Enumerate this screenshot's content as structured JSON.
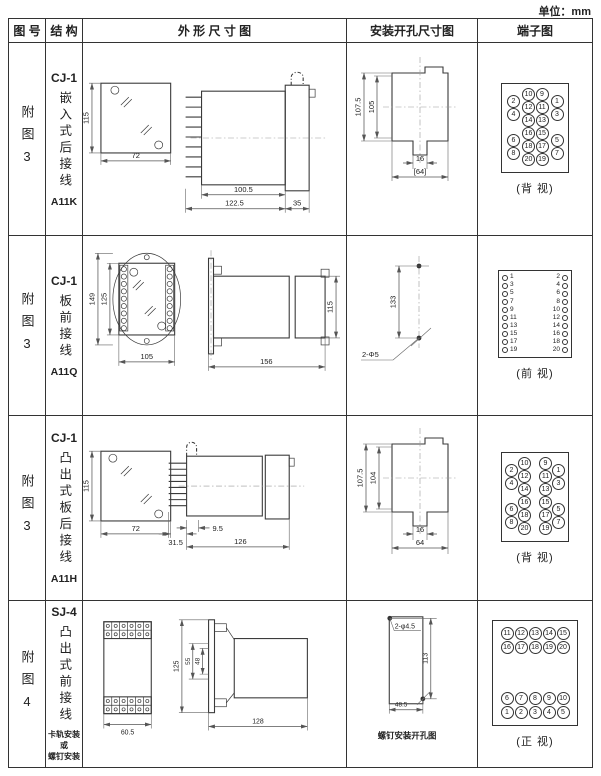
{
  "unit": "单位：mm",
  "header": {
    "fig_no": "图 号",
    "structure": "结 构",
    "outline": "外 形 尺 寸 图",
    "install": "安装开孔尺寸图",
    "terminal": "端子图"
  },
  "rows": [
    {
      "fig": "附图3",
      "model": "CJ-1",
      "structure": "嵌入式后接线",
      "code": "A11K",
      "outline": {
        "h": "115",
        "w": "72",
        "body": "100.5",
        "total": "122.5",
        "flange": "35"
      },
      "install": {
        "h_outer": "107.5",
        "h_inner": "105",
        "notch": "16",
        "width": "[64]"
      },
      "terminal": {
        "label": "(背 视)",
        "outer_left": [
          "2",
          "4",
          "6",
          "8"
        ],
        "inner_left": [
          "10",
          "12",
          "14",
          "16",
          "18",
          "20"
        ],
        "inner_right": [
          "9",
          "11",
          "13",
          "15",
          "17",
          "19"
        ],
        "outer_right": [
          "1",
          "3",
          "5",
          "7"
        ]
      }
    },
    {
      "fig": "附图3",
      "model": "CJ-1",
      "structure": "板前接线",
      "code": "A11Q",
      "outline": {
        "h_outer": "149",
        "h_inner": "125",
        "w": "105",
        "side_len": "156",
        "side_h": "115"
      },
      "install": {
        "pitch": "133",
        "holes": "2-Φ5"
      },
      "terminal": {
        "label": "(前 视)",
        "left": [
          "1",
          "3",
          "5",
          "7",
          "9",
          "11",
          "13",
          "15",
          "17",
          "19"
        ],
        "right": [
          "2",
          "4",
          "6",
          "8",
          "10",
          "12",
          "14",
          "16",
          "18",
          "20"
        ]
      }
    },
    {
      "fig": "附图3",
      "model": "CJ-1",
      "structure": "凸出式板后接线",
      "code": "A11H",
      "outline": {
        "h": "115",
        "w": "72",
        "pin_len": "31.5",
        "offset": "9.5",
        "body": "126"
      },
      "install": {
        "h_outer": "107.5",
        "h_inner": "104",
        "notch": "16",
        "width": "64"
      },
      "terminal": {
        "label": "(背 视)",
        "outer_left": [
          "2",
          "4",
          "6",
          "8"
        ],
        "inner_left": [
          "10",
          "12",
          "14",
          "16",
          "18",
          "20"
        ],
        "inner_right": [
          "9",
          "11",
          "13",
          "15",
          "17",
          "19"
        ],
        "outer_right": [
          "1",
          "3",
          "5",
          "7"
        ]
      }
    },
    {
      "fig": "附图4",
      "model": "SJ-4",
      "structure": "凸出式前接线",
      "mount": [
        "卡轨安装",
        "或",
        "螺钉安装"
      ],
      "outline": {
        "w": "60.5",
        "h": "125",
        "h2": "55",
        "h3": "48",
        "side_len": "128"
      },
      "install": {
        "holes": "2-φ4.5",
        "h": "113",
        "w": "48.5",
        "caption": "螺钉安装开孔图"
      },
      "terminal": {
        "label": "(正 视)",
        "row1": [
          "11",
          "12",
          "13",
          "14",
          "15"
        ],
        "row2": [
          "16",
          "17",
          "18",
          "19",
          "20"
        ],
        "row3": [
          "6",
          "7",
          "8",
          "9",
          "10"
        ],
        "row4": [
          "1",
          "2",
          "3",
          "4",
          "5"
        ]
      }
    }
  ]
}
